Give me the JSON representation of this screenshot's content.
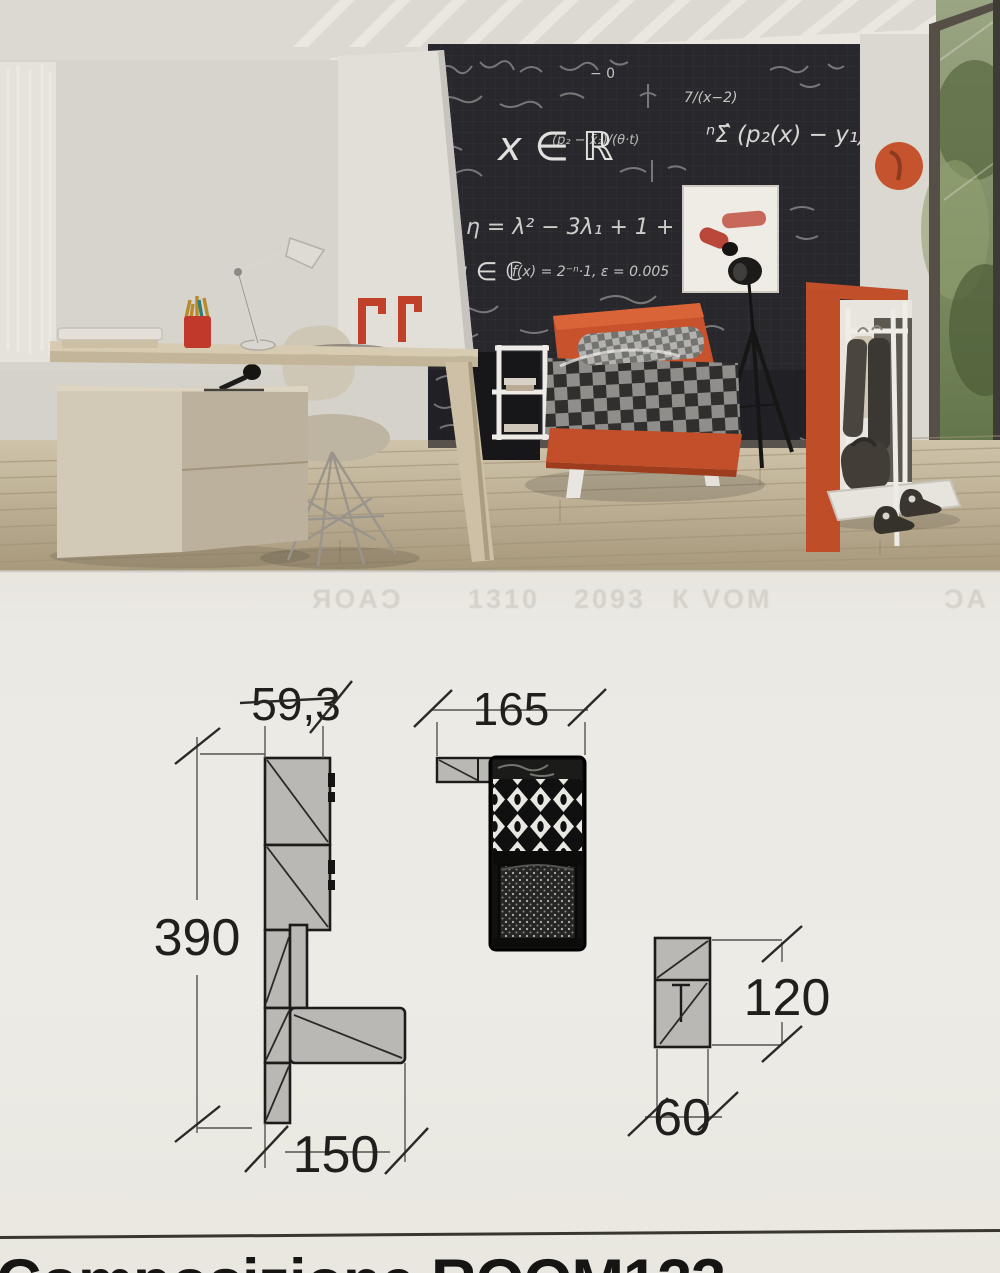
{
  "page": {
    "composition_title": "Composizione ROOM123"
  },
  "photo": {
    "description": "teen bedroom with chalkboard wall, orange bed with checkered duvet, desk and clothes rack",
    "chalkboard": {
      "formulas": [
        {
          "text": "x ∈ ℝ"
        },
        {
          "text": "ⁿΣ̂ (p₂(x) − y₁)²"
        },
        {
          "text": "η = λ² − 3λ₁ + 1 + 0"
        },
        {
          "text": "β, μ ∈ ℂ"
        },
        {
          "text": "f(x) = 2⁻ⁿ·1, ε = 0.005"
        },
        {
          "text": "7/(x−2)"
        },
        {
          "text": "(p₂ − x̄₂)/(θ·t)"
        },
        {
          "text": "− 0"
        }
      ]
    }
  },
  "ghost": {
    "items": [
      {
        "text": "ЯOΑϽ"
      },
      {
        "text": "1310"
      },
      {
        "text": "2093"
      },
      {
        "text": "К VOM"
      },
      {
        "text": "ϽΑ"
      }
    ]
  },
  "diagram": {
    "left_top_width": "59,3",
    "left_height": "390",
    "left_bottom_width": "150",
    "bed_width": "165",
    "unit_height": "120",
    "unit_width": "60"
  },
  "colors": {
    "accent_orange": "#c24e2a",
    "chalkboard": "#27272c",
    "paper": "#ebe9e3",
    "diagram_gray": "#b9b8b4"
  }
}
